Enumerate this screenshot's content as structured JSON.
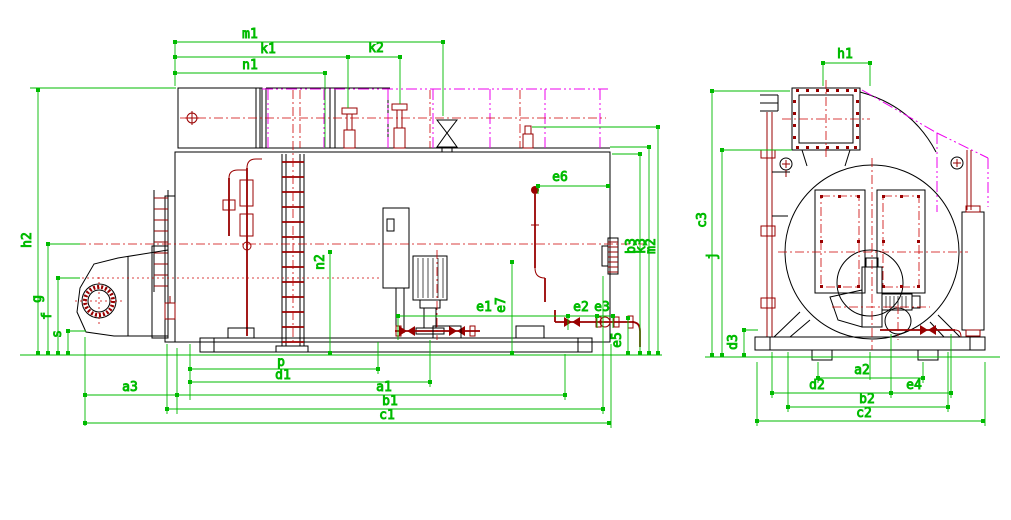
{
  "dims": {
    "m1": "m1",
    "k1": "k1",
    "k2": "k2",
    "n1": "n1",
    "n2": "n2",
    "h2": "h2",
    "g": "g",
    "f": "f",
    "s": "s",
    "e1": "e1",
    "e2": "e2",
    "e3": "e3",
    "e5": "e5",
    "e6": "e6",
    "e7": "e7",
    "b3": "b3",
    "k3": "k3",
    "m2": "m2",
    "p": "p",
    "d1": "d1",
    "a3": "a3",
    "a1": "a1",
    "b1": "b1",
    "c1": "c1",
    "h1": "h1",
    "c3": "c3",
    "j": "j",
    "d3": "d3",
    "a2": "a2",
    "d2": "d2",
    "e4": "e4",
    "b2": "b2",
    "c2": "c2"
  },
  "colors": {
    "dimension": "#00bb00",
    "outline": "#000000",
    "detail": "#990000",
    "centerline": "#cc0000",
    "phantom": "#ee00ee",
    "background": "#ffffff"
  }
}
